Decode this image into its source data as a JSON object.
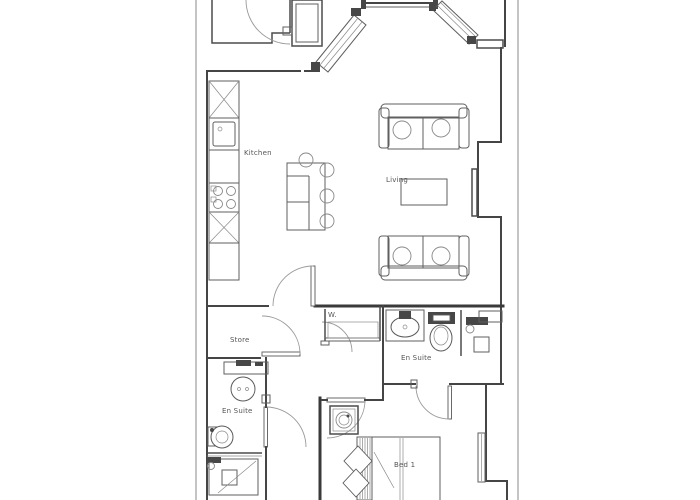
{
  "page": {
    "background": "#ffffff",
    "drawing_type": "apartment floor plan"
  },
  "floorplan": {
    "line_color": "#4a4a4a",
    "label_color": "#555555",
    "rooms": {
      "kitchen": {
        "label": "Kitchen"
      },
      "living": {
        "label": "Living"
      },
      "store": {
        "label": "Store"
      },
      "wardrobe": {
        "label": "W."
      },
      "ensuite_right": {
        "label": "En Suite"
      },
      "ensuite_left": {
        "label": "En Suite"
      },
      "bedroom": {
        "label": "Bed 1"
      }
    },
    "fixtures": [
      "entry-door-swing",
      "angled-entry-window-left",
      "angled-entry-window-right",
      "kitchen-cabinet-x2",
      "kitchen-sink",
      "kitchen-hob",
      "kitchen-island",
      "bar-stools-x4",
      "sofa-x2",
      "coffee-table",
      "tv",
      "store-door",
      "wardrobe-closet",
      "wash-basin-x2",
      "toilet-x2",
      "shower-x2",
      "washing-machine",
      "double-bed",
      "pillows-x2",
      "bedroom-window",
      "internal-door-swings-x6"
    ]
  }
}
